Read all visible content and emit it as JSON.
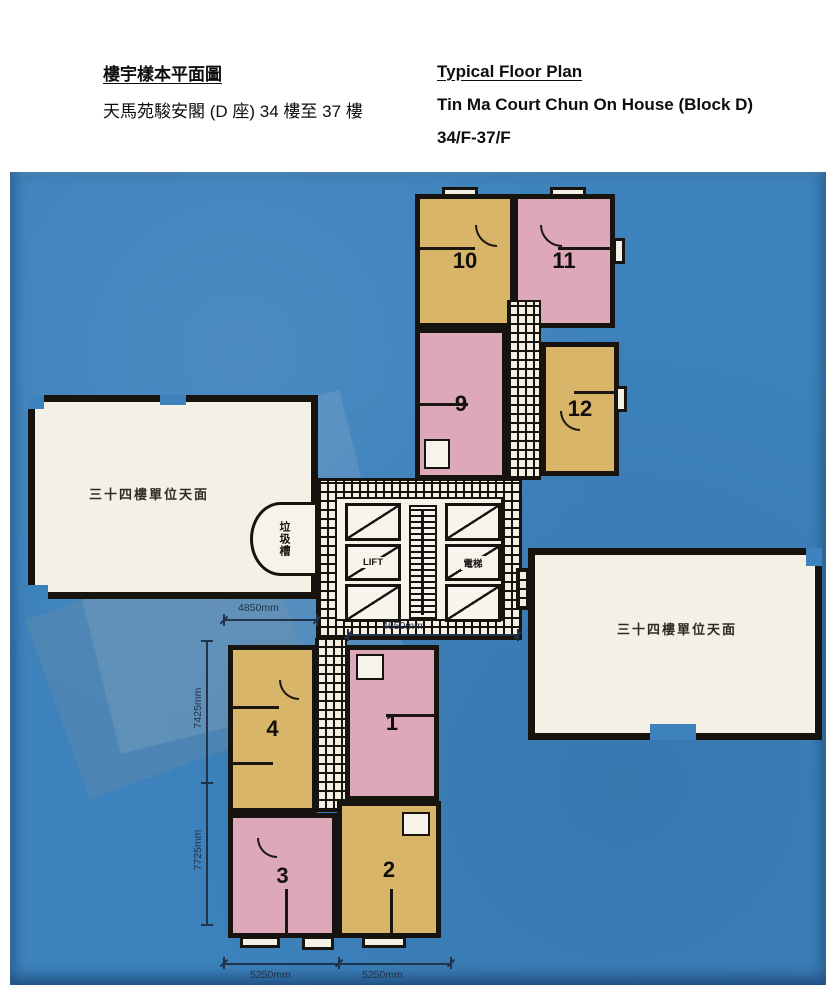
{
  "header": {
    "zh_title": "樓宇樣本平面圖",
    "zh_subtitle": "天馬苑駿安閣 (D 座) 34 樓至 37 樓",
    "en_title": "Typical Floor Plan",
    "en_subtitle": "Tin Ma Court Chun On House (Block D)",
    "en_floors": "34/F-37/F"
  },
  "plan": {
    "unit_numbers": {
      "u10": "10",
      "u11": "11",
      "u9": "9",
      "u12": "12",
      "u4": "4",
      "u1": "1",
      "u3": "3",
      "u2": "2"
    },
    "core": {
      "lift_label_en": "LIFT",
      "lift_label_zh": "電梯"
    },
    "refuse_chute_label": "垃圾槽",
    "roof_label_left": "三十四樓單位天面",
    "roof_label_right": "三十四樓單位天面",
    "dimensions": {
      "top_wing_width": "4850mm",
      "core_width": "4650mm",
      "left_upper_height": "7425mm",
      "left_lower_height": "7725mm",
      "bottom_left_width": "5250mm",
      "bottom_right_width": "5250mm"
    },
    "colors": {
      "scan_blue": "#3d82bc",
      "unit_tan": "#d8b568",
      "unit_pink": "#dda9ba",
      "roof_white": "#f3f0e6",
      "wall_black": "#17130e"
    }
  }
}
